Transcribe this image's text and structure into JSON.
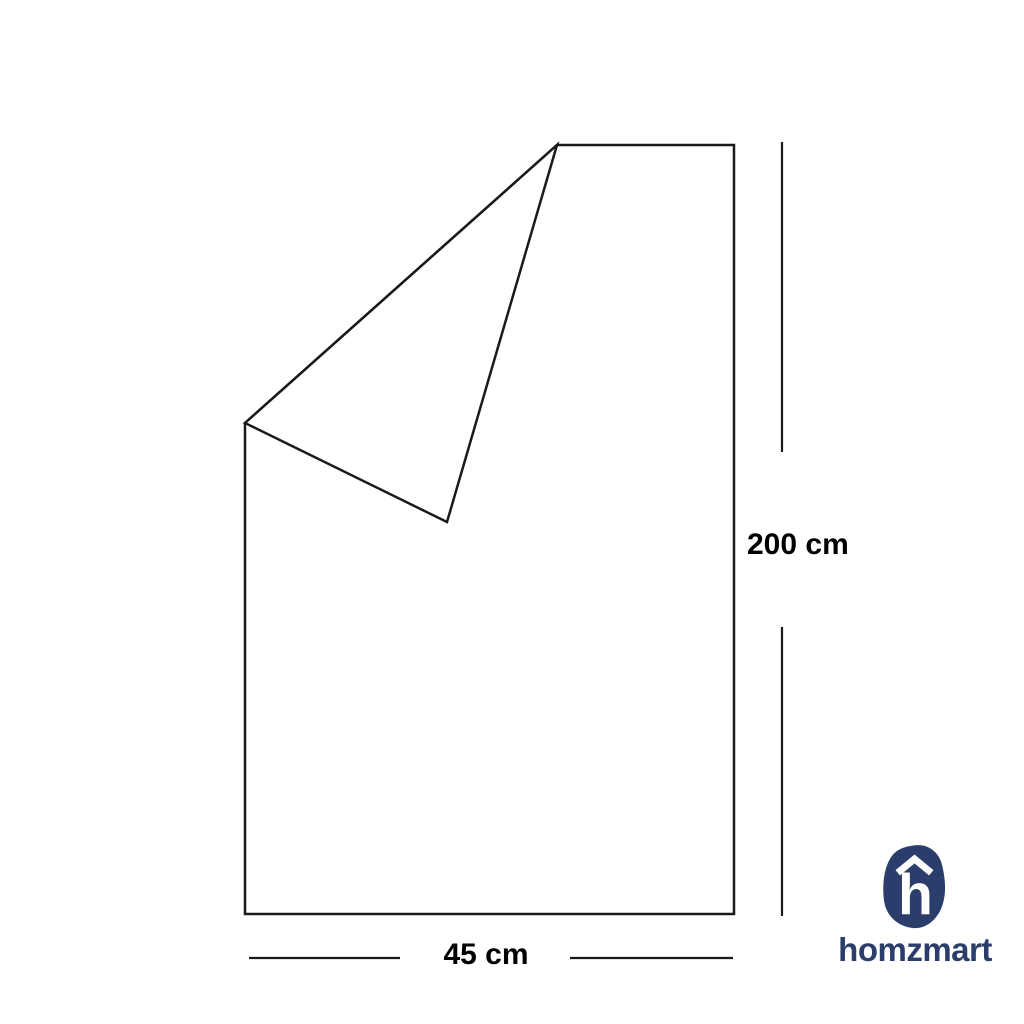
{
  "canvas": {
    "background_color": "#ffffff",
    "line_color": "#1a1a1a"
  },
  "diagram": {
    "type": "folded-sheet-dimension-diagram",
    "height_label": "200 cm",
    "width_label": "45 cm",
    "sheet_outline_points": "557,145 734,145 734,914 245,914 245,423",
    "fold_flap_points": "557,145 447,522 245,423",
    "height_dim_upper_points": "782,142 782,452",
    "height_dim_lower_points": "782,627 782,916",
    "width_dim_left_points": "249,958 400,958",
    "width_dim_right_points": "570,958 733,958"
  },
  "branding": {
    "logo_text": "homzmart",
    "logo_letter": "h",
    "logo_icon": "homzmart-pebble-h-icon",
    "brand_color": "#2b3e6b"
  }
}
